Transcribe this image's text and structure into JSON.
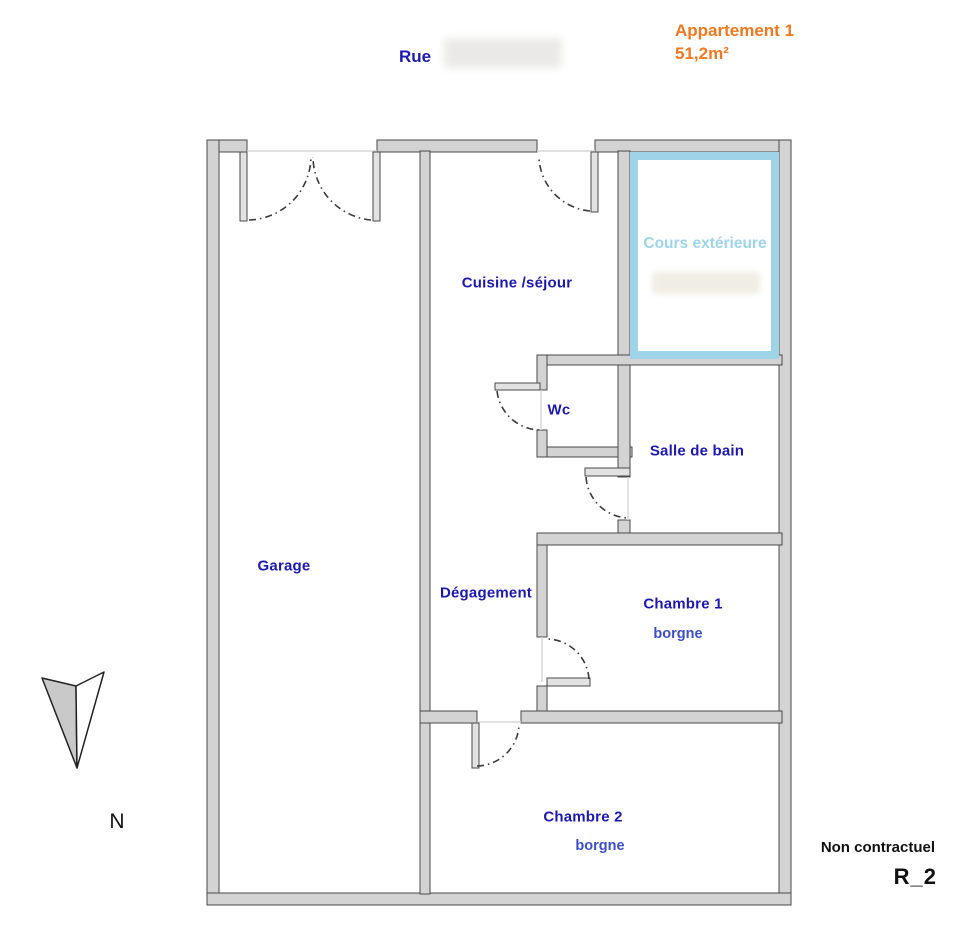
{
  "header": {
    "street_label": "Rue",
    "apartment_name": "Appartement 1",
    "apartment_area": "51,2m²"
  },
  "rooms": {
    "garage": "Garage",
    "kitchen_living": "Cuisine /séjour",
    "wc": "Wc",
    "bathroom": "Salle de bain",
    "hallway": "Dégagement",
    "bedroom1": "Chambre 1",
    "bedroom1_note": "borgne",
    "bedroom2": "Chambre 2",
    "bedroom2_note": "borgne",
    "courtyard": "Cours extérieure"
  },
  "compass": {
    "north_label": "N"
  },
  "footer": {
    "disclaimer": "Non contractuel",
    "plan_ref": "R_2"
  },
  "colors": {
    "label_blue": "#1c18b0",
    "note_blue": "#3d4fc8",
    "cours_blue": "#9fd4e8",
    "accent_orange": "#f07820",
    "wall_fill": "#d3d3d3",
    "wall_stroke": "#4a4a4a",
    "text_black": "#111111"
  }
}
